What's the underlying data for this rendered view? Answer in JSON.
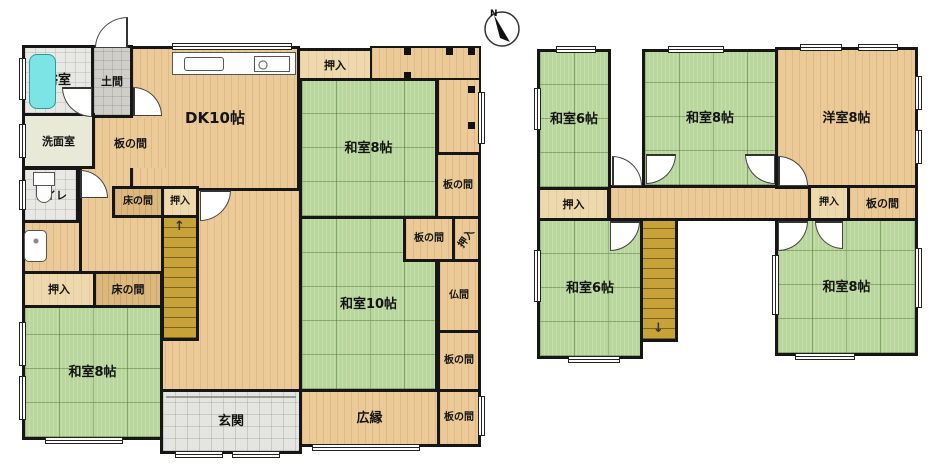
{
  "compass": {
    "north": "N"
  },
  "icons": {
    "up_arrow": "↑",
    "down_arrow": "↓"
  },
  "colors": {
    "tatami_green": "#b9d69d",
    "wood_floor": "#ecca98",
    "stairs_brown": "#c7a238",
    "bathtub_cyan": "#7de4e6",
    "entry_tile_gray": "#e4e4e1",
    "wall_black": "#161616"
  },
  "floor1": {
    "rooms": {
      "bathroom": "浴室",
      "doma": "土間",
      "dk": "DK10帖",
      "oshiire_n": "押入",
      "washitsu8_ne": "和室8帖",
      "senmen": "洗面室",
      "itanoma_w": "板の間",
      "toilet": "トイレ",
      "tokonoma_c": "床の間",
      "oshiire_c": "押入",
      "itanoma_ne": "板の間",
      "itanoma_mid": "板の間",
      "oshiire_e": "押入",
      "washitsu10": "和室10帖",
      "butsuma": "仏間",
      "itanoma_e": "板の間",
      "oshiire_sw": "押入",
      "tokonoma_sw": "床の間",
      "washitsu8_sw": "和室8帖",
      "genkan": "玄関",
      "hiroen": "広縁",
      "itanoma_se": "板の間"
    }
  },
  "floor2": {
    "rooms": {
      "washitsu6_nw": "和室6帖",
      "washitsu8_n": "和室8帖",
      "yoshitsu8": "洋室8帖",
      "oshiire_w": "押入",
      "oshiire_e": "押入",
      "itanoma_e": "板の間",
      "washitsu6_sw": "和室6帖",
      "washitsu8_se": "和室8帖"
    }
  }
}
